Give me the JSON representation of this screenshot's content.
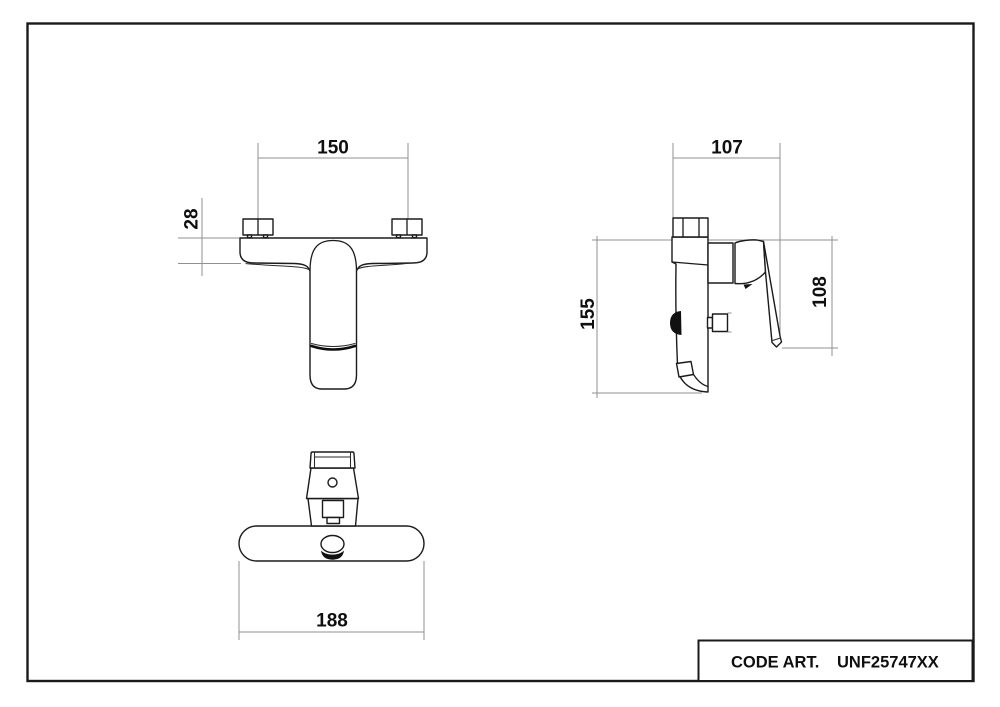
{
  "title_block": {
    "label": "CODE ART.",
    "value": "UNF25747XX"
  },
  "views": {
    "front_view": {
      "dim_width": "150",
      "dim_plate_height": "28"
    },
    "side_view": {
      "dim_depth": "107",
      "dim_height": "155",
      "dim_lever_height": "108"
    },
    "bottom_view": {
      "dim_length": "188"
    }
  },
  "colors": {
    "outline": "#1b1b1b",
    "dimension_line": "#909090",
    "text": "#0f0f0f",
    "background": "#ffffff"
  }
}
